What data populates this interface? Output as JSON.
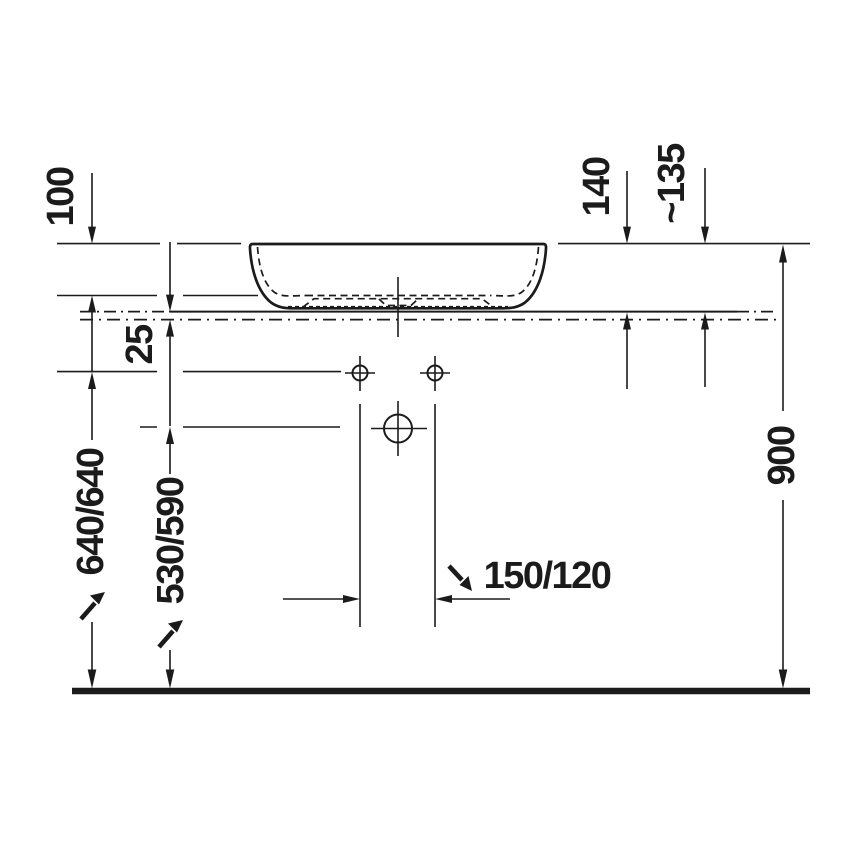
{
  "drawing": {
    "kind": "washbasin installation dimension drawing, side elevation",
    "colors": {
      "ink": "#1b1b1b",
      "background": "#ffffff"
    },
    "labels": {
      "bowl_depth": "100",
      "basin_height_back": "140",
      "basin_height_front": "~135",
      "counter_thickness": "25",
      "supply_height": "640/640",
      "drain_height": "530/590",
      "drain_offset": "150/120",
      "rim_height": "900"
    }
  }
}
